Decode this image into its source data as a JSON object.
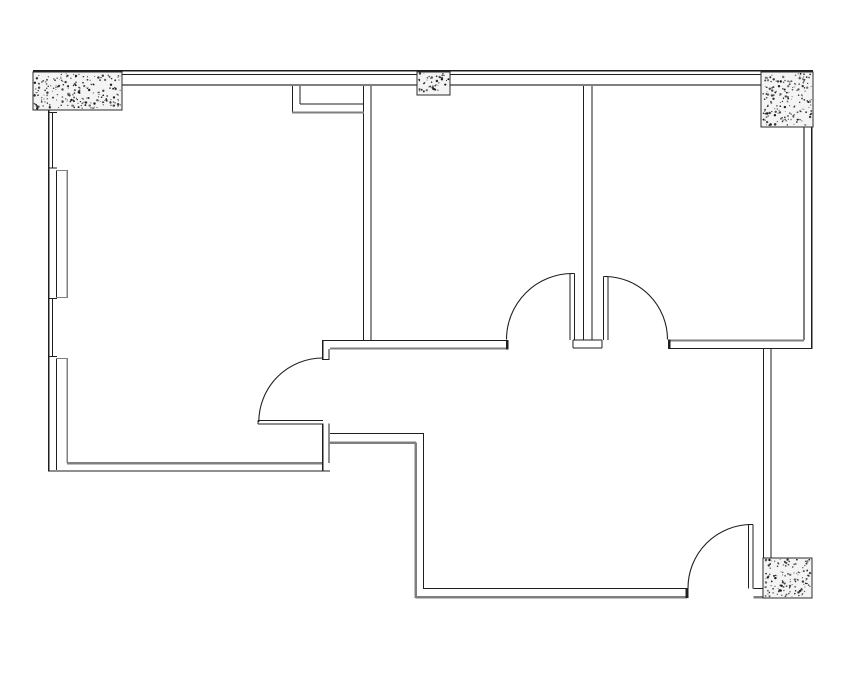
{
  "drawing": {
    "type": "architectural-floor-plan",
    "background": "#ffffff",
    "canvas": {
      "width": 855,
      "height": 678
    }
  },
  "colors": {
    "wall_line": "#1f1f1f",
    "inner_face_line": "#7f7f7f",
    "column_fill": "#f4f4f4",
    "column_border": "#2b2b2b",
    "column_dot": "#141414"
  },
  "columns": [
    {
      "name": "column-top-left",
      "x": 33,
      "y": 72,
      "w": 89,
      "h": 38
    },
    {
      "name": "column-top-middle",
      "x": 417,
      "y": 72,
      "w": 33,
      "h": 23
    },
    {
      "name": "column-top-right",
      "x": 761,
      "y": 72,
      "w": 52,
      "h": 55
    },
    {
      "name": "column-bottom-right",
      "x": 763,
      "y": 558,
      "w": 49,
      "h": 40
    }
  ],
  "wall_segments": [
    {
      "n": "top-wall-outer",
      "x1": 33,
      "y1": 70.5,
      "x2": 813,
      "y2": 70.5,
      "w": 1.5,
      "c": "k"
    },
    {
      "n": "top-wall-outer-second",
      "x1": 33,
      "y1": 74.5,
      "x2": 813,
      "y2": 74.5,
      "w": 1,
      "c": "k"
    },
    {
      "n": "top-wall-inner",
      "x1": 50,
      "y1": 85,
      "x2": 806,
      "y2": 85,
      "w": 2.2,
      "c": "g"
    },
    {
      "n": "left-wall-outer",
      "x1": 48.5,
      "y1": 110,
      "x2": 48.5,
      "y2": 471,
      "w": 1.5,
      "c": "k"
    },
    {
      "n": "window1-glazing",
      "x1": 52.6,
      "y1": 112,
      "x2": 52.6,
      "y2": 168,
      "w": 1,
      "c": "k"
    },
    {
      "n": "window1-head",
      "x1": 48,
      "y1": 112.5,
      "x2": 57,
      "y2": 112.5,
      "w": 1,
      "c": "k"
    },
    {
      "n": "window1-sill",
      "x1": 48,
      "y1": 168,
      "x2": 57,
      "y2": 168,
      "w": 1,
      "c": "k"
    },
    {
      "n": "window2-glazing",
      "x1": 52.6,
      "y1": 299,
      "x2": 52.6,
      "y2": 357,
      "w": 1,
      "c": "k"
    },
    {
      "n": "window2-head",
      "x1": 48,
      "y1": 298.7,
      "x2": 57,
      "y2": 298.7,
      "w": 1,
      "c": "k"
    },
    {
      "n": "window2-sill",
      "x1": 48,
      "y1": 356.6,
      "x2": 57,
      "y2": 356.6,
      "w": 1,
      "c": "k"
    },
    {
      "n": "left-wall-inner-pier-upper",
      "x1": 56.5,
      "y1": 170,
      "x2": 56.5,
      "y2": 298.5,
      "w": 1,
      "c": "k"
    },
    {
      "n": "left-wall-inner-pier-lower",
      "x1": 56.5,
      "y1": 358,
      "x2": 56.5,
      "y2": 470,
      "w": 1,
      "c": "k"
    },
    {
      "n": "left-ledge-upper",
      "x1": 67.3,
      "y1": 170,
      "x2": 67.3,
      "y2": 298,
      "w": 1.8,
      "c": "g"
    },
    {
      "n": "left-ledge-lower",
      "x1": 67.3,
      "y1": 358,
      "x2": 67.3,
      "y2": 463,
      "w": 1.8,
      "c": "g"
    },
    {
      "n": "ledge-step-top",
      "x1": 56,
      "y1": 170.5,
      "x2": 68,
      "y2": 170.5,
      "w": 1.4,
      "c": "g"
    },
    {
      "n": "ledge-step-mid-upper",
      "x1": 56,
      "y1": 297.5,
      "x2": 68,
      "y2": 297.5,
      "w": 1.4,
      "c": "g"
    },
    {
      "n": "ledge-step-mid-lower",
      "x1": 56,
      "y1": 358.5,
      "x2": 68,
      "y2": 358.5,
      "w": 1.4,
      "c": "g"
    },
    {
      "n": "left-room-south-wall-inner",
      "x1": 67,
      "y1": 463.2,
      "x2": 322.8,
      "y2": 463.2,
      "w": 2.4,
      "c": "g"
    },
    {
      "n": "left-room-south-wall-outer",
      "x1": 48,
      "y1": 471,
      "x2": 330,
      "y2": 471,
      "w": 1.3,
      "c": "k"
    },
    {
      "n": "door1-pier-outer",
      "x1": 322.8,
      "y1": 423.5,
      "x2": 322.8,
      "y2": 471,
      "w": 1.2,
      "c": "k"
    },
    {
      "n": "door1-pier-inner",
      "x1": 329.2,
      "y1": 423.5,
      "x2": 329.2,
      "y2": 463.2,
      "w": 1,
      "c": "k"
    },
    {
      "n": "door1-leaf-top",
      "x1": 258,
      "y1": 420.5,
      "x2": 322.8,
      "y2": 420.5,
      "w": 1,
      "c": "k"
    },
    {
      "n": "door1-leaf-bottom",
      "x1": 258,
      "y1": 424,
      "x2": 322.8,
      "y2": 424,
      "w": 1,
      "c": "k"
    },
    {
      "n": "door1-leaf-cap",
      "x1": 258,
      "y1": 420.5,
      "x2": 258,
      "y2": 424,
      "w": 1,
      "c": "k"
    },
    {
      "n": "door1-jamb-outer",
      "x1": 322.8,
      "y1": 340,
      "x2": 322.8,
      "y2": 360,
      "w": 1.2,
      "c": "k"
    },
    {
      "n": "door1-jamb-inner",
      "x1": 329.2,
      "y1": 349,
      "x2": 329.2,
      "y2": 360,
      "w": 1,
      "c": "k"
    },
    {
      "n": "door1-jamb-cap",
      "x1": 322.3,
      "y1": 359.6,
      "x2": 329.7,
      "y2": 359.6,
      "w": 1,
      "c": "k"
    },
    {
      "n": "hall-north-wall-inner",
      "x1": 323,
      "y1": 340.3,
      "x2": 506.5,
      "y2": 340.3,
      "w": 1,
      "c": "k"
    },
    {
      "n": "hall-north-wall-outer",
      "x1": 330,
      "y1": 348.6,
      "x2": 506.5,
      "y2": 348.6,
      "w": 2.2,
      "c": "g"
    },
    {
      "n": "hall-north-wall-cap",
      "x1": 507.2,
      "y1": 339.8,
      "x2": 507.2,
      "y2": 349.6,
      "w": 2.8,
      "c": "k"
    },
    {
      "n": "room1-room2-wall-left",
      "x1": 363.7,
      "y1": 86,
      "x2": 363.7,
      "y2": 340.5,
      "w": 1,
      "c": "k"
    },
    {
      "n": "room1-room2-wall-right",
      "x1": 370.9,
      "y1": 86,
      "x2": 370.9,
      "y2": 340.5,
      "w": 1,
      "c": "k"
    },
    {
      "n": "soffit-left",
      "x1": 292.4,
      "y1": 86,
      "x2": 292.4,
      "y2": 112.5,
      "w": 1,
      "c": "k"
    },
    {
      "n": "soffit-inner-left",
      "x1": 300,
      "y1": 86,
      "x2": 300,
      "y2": 104,
      "w": 1,
      "c": "k"
    },
    {
      "n": "soffit-inner-bottom",
      "x1": 300,
      "y1": 104,
      "x2": 364,
      "y2": 104,
      "w": 1,
      "c": "k"
    },
    {
      "n": "soffit-bottom",
      "x1": 292,
      "y1": 112.5,
      "x2": 364,
      "y2": 112.5,
      "w": 2,
      "c": "g"
    },
    {
      "n": "room2-room3-wall-left",
      "x1": 583.6,
      "y1": 86,
      "x2": 583.6,
      "y2": 340,
      "w": 1,
      "c": "k"
    },
    {
      "n": "room2-room3-wall-right",
      "x1": 592,
      "y1": 86,
      "x2": 592,
      "y2": 340,
      "w": 1,
      "c": "k"
    },
    {
      "n": "partition-foot-top",
      "x1": 573,
      "y1": 340,
      "x2": 602,
      "y2": 340,
      "w": 1,
      "c": "k"
    },
    {
      "n": "partition-foot-bottom",
      "x1": 573,
      "y1": 348,
      "x2": 602,
      "y2": 348,
      "w": 1.3,
      "c": "k"
    },
    {
      "n": "partition-foot-left",
      "x1": 573,
      "y1": 340,
      "x2": 573,
      "y2": 348,
      "w": 1,
      "c": "k"
    },
    {
      "n": "partition-foot-right",
      "x1": 602,
      "y1": 340,
      "x2": 602,
      "y2": 348,
      "w": 1,
      "c": "k"
    },
    {
      "n": "door2-leaf-left",
      "x1": 570.2,
      "y1": 273.5,
      "x2": 570.2,
      "y2": 340,
      "w": 1,
      "c": "k"
    },
    {
      "n": "door2-leaf-right",
      "x1": 574.4,
      "y1": 273.5,
      "x2": 574.4,
      "y2": 340,
      "w": 1,
      "c": "k"
    },
    {
      "n": "door2-leaf-cap",
      "x1": 570.2,
      "y1": 273.5,
      "x2": 574.4,
      "y2": 273.5,
      "w": 1,
      "c": "k"
    },
    {
      "n": "door3-leaf-left",
      "x1": 603.6,
      "y1": 276.5,
      "x2": 603.6,
      "y2": 340,
      "w": 1,
      "c": "k"
    },
    {
      "n": "door3-leaf-right",
      "x1": 607.8,
      "y1": 276.5,
      "x2": 607.8,
      "y2": 340,
      "w": 1,
      "c": "k"
    },
    {
      "n": "door3-leaf-cap",
      "x1": 603.6,
      "y1": 276.5,
      "x2": 607.8,
      "y2": 276.5,
      "w": 1,
      "c": "k"
    },
    {
      "n": "room3-south-wall-inner",
      "x1": 668,
      "y1": 340.4,
      "x2": 804,
      "y2": 340.4,
      "w": 2.2,
      "c": "g"
    },
    {
      "n": "room3-south-wall-outer",
      "x1": 668,
      "y1": 348.4,
      "x2": 812,
      "y2": 348.4,
      "w": 1.3,
      "c": "k"
    },
    {
      "n": "room3-south-wall-cap",
      "x1": 669.2,
      "y1": 339.6,
      "x2": 669.2,
      "y2": 349,
      "w": 2.8,
      "c": "k"
    },
    {
      "n": "right-wall-outer",
      "x1": 811.6,
      "y1": 127,
      "x2": 811.6,
      "y2": 349,
      "w": 1.5,
      "c": "k"
    },
    {
      "n": "right-wall-inner",
      "x1": 803.9,
      "y1": 127,
      "x2": 803.9,
      "y2": 340,
      "w": 2.2,
      "c": "g"
    },
    {
      "n": "corridor-east-wall-inner",
      "x1": 763.7,
      "y1": 348.4,
      "x2": 763.7,
      "y2": 558,
      "w": 1,
      "c": "k"
    },
    {
      "n": "corridor-east-wall-outer",
      "x1": 770.9,
      "y1": 348.4,
      "x2": 770.9,
      "y2": 558,
      "w": 1,
      "c": "k"
    },
    {
      "n": "lower-hall-north-wall-inner",
      "x1": 330,
      "y1": 433.5,
      "x2": 424.2,
      "y2": 433.5,
      "w": 1,
      "c": "k"
    },
    {
      "n": "lower-hall-north-wall-outer",
      "x1": 329,
      "y1": 442.7,
      "x2": 416.2,
      "y2": 442.7,
      "w": 2.4,
      "c": "g"
    },
    {
      "n": "corridor-west-wall-inner",
      "x1": 423.7,
      "y1": 433.5,
      "x2": 423.7,
      "y2": 589.2,
      "w": 1,
      "c": "k"
    },
    {
      "n": "corridor-west-wall-outer",
      "x1": 415.7,
      "y1": 442.7,
      "x2": 415.7,
      "y2": 597.8,
      "w": 2.4,
      "c": "g"
    },
    {
      "n": "corridor-south-wall-inner",
      "x1": 423.7,
      "y1": 588.7,
      "x2": 687,
      "y2": 588.7,
      "w": 1,
      "c": "k"
    },
    {
      "n": "corridor-south-wall-outer",
      "x1": 415.7,
      "y1": 597.3,
      "x2": 687,
      "y2": 597.3,
      "w": 2.4,
      "c": "g"
    },
    {
      "n": "corridor-south-wall-cap",
      "x1": 686.9,
      "y1": 588,
      "x2": 686.9,
      "y2": 598,
      "w": 2.8,
      "c": "k"
    },
    {
      "n": "door4-jamb-inner",
      "x1": 753.4,
      "y1": 588.7,
      "x2": 764,
      "y2": 588.7,
      "w": 1,
      "c": "k"
    },
    {
      "n": "door4-jamb-outer",
      "x1": 753.4,
      "y1": 597.3,
      "x2": 764,
      "y2": 597.3,
      "w": 2.4,
      "c": "g"
    },
    {
      "n": "door4-leaf-left",
      "x1": 748.7,
      "y1": 524.5,
      "x2": 748.7,
      "y2": 588.5,
      "w": 1,
      "c": "k"
    },
    {
      "n": "door4-leaf-right",
      "x1": 753.1,
      "y1": 524.5,
      "x2": 753.1,
      "y2": 588.5,
      "w": 1,
      "c": "k"
    },
    {
      "n": "door4-leaf-cap",
      "x1": 748.7,
      "y1": 524.5,
      "x2": 753.1,
      "y2": 524.5,
      "w": 1,
      "c": "k"
    }
  ],
  "door_swing_arcs": [
    {
      "n": "door1-swing-arc",
      "x1": 258.8,
      "y1": 422,
      "r": 64,
      "x2": 322.8,
      "y2": 358,
      "sweep": 1
    },
    {
      "n": "door2-swing-arc",
      "x1": 506.5,
      "y1": 339.5,
      "r": 66,
      "x2": 572.5,
      "y2": 273.5,
      "sweep": 1
    },
    {
      "n": "door3-swing-arc",
      "x1": 604.5,
      "y1": 276.5,
      "r": 63,
      "x2": 667.5,
      "y2": 339.5,
      "sweep": 1
    },
    {
      "n": "door4-swing-arc",
      "x1": 688,
      "y1": 588,
      "r": 63.5,
      "x2": 751.5,
      "y2": 524.5,
      "sweep": 1
    }
  ]
}
